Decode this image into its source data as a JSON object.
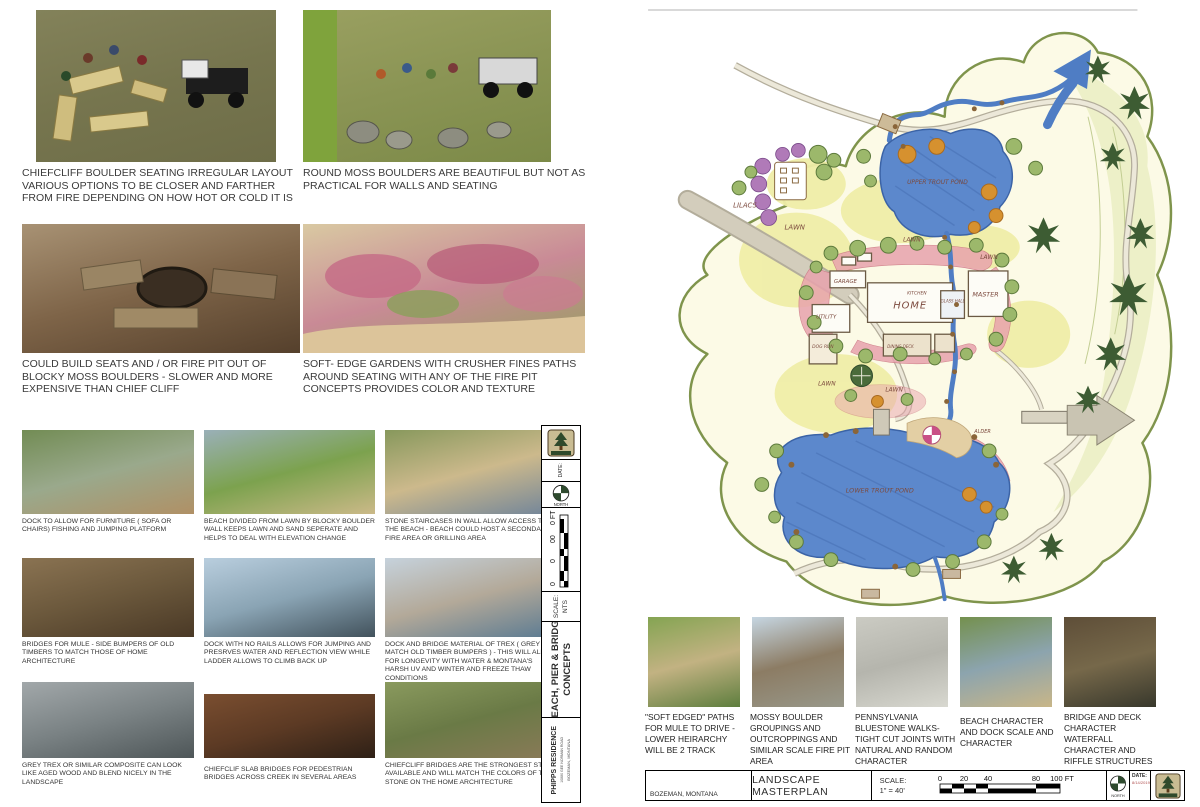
{
  "page_left": {
    "concepts": [
      {
        "id": "chiefcliff-seating-sketch",
        "caption": "CHIEFCLIFF BOULDER SEATING IRREGULAR LAYOUT VARIOUS OPTIONS TO BE CLOSER AND FARTHER FROM FIRE DEPENDING ON HOW HOT OR COLD IT IS",
        "colors": [
          "#83825a",
          "#76754e",
          "#6e6d48"
        ]
      },
      {
        "id": "round-moss-boulders-sketch",
        "caption": "ROUND MOSS BOULDERS ARE BEAUTIFUL BUT NOT AS PRACTICAL FOR WALLS AND SEATING",
        "colors": [
          "#9aa061",
          "#8a9454",
          "#7c8a48"
        ]
      },
      {
        "id": "blocky-moss-fire-pit-photo",
        "caption": "COULD BUILD SEATS AND  / OR FIRE PIT OUT OF BLOCKY MOSS BOULDERS - SLOWER AND MORE EXPENSIVE THAN CHIEF CLIFF",
        "colors": [
          "#a89274",
          "#7e6448",
          "#55402c"
        ]
      },
      {
        "id": "soft-edge-gardens-photo",
        "caption": "SOFT- EDGE GARDENS WITH CRUSHER FINES PATHS AROUND SEATING WITH ANY OF THE FIRE PIT CONCEPTS PROVIDES COLOR AND TEXTURE",
        "colors": [
          "#d9c9a2",
          "#c98a96",
          "#95a05e"
        ]
      }
    ],
    "grid": [
      {
        "id": "dock-furniture-photo",
        "caption": "DOCK TO ALLOW FOR FURNITURE   ( SOFA OR CHAIRS) FISHING AND JUMPING PLATFORM",
        "colors": [
          "#728c54",
          "#9aa98c",
          "#b09065"
        ]
      },
      {
        "id": "beach-lawn-wall-photo",
        "caption": "BEACH DIVIDED FROM LAWN BY BLOCKY BOULDER WALL KEEPS LAWN AND SAND SEPERATE AND HELPS TO DEAL WITH ELEVATION CHANGE",
        "colors": [
          "#9ab0b8",
          "#7ca24e",
          "#cbb988"
        ]
      },
      {
        "id": "stone-staircase-photo",
        "caption": "STONE STAIRCASES IN WALL ALLOW ACCESS TO THE BEACH - BEACH COULD HOST A SECONDARY FIRE AREA OR GRILLING AREA",
        "colors": [
          "#87985c",
          "#ccb98c",
          "#70849a"
        ]
      },
      {
        "id": "mule-bridge-photo",
        "caption": "BRIDGES FOR MULE - SIDE BUMPERS OF OLD TIMBERS TO MATCH THOSE OF HOME ARCHITECTURE",
        "colors": [
          "#8a7352",
          "#6b583c",
          "#4a3926"
        ]
      },
      {
        "id": "dock-no-rails-photo",
        "caption": "DOCK WITH NO RAILS ALLOWS FOR JUMPING AND PRESRVES WATER AND REFLECTION VIEW WHILE LADDER ALLOWS TO CLIMB BACK UP",
        "colors": [
          "#b9cede",
          "#8aa4b4",
          "#42525c"
        ]
      },
      {
        "id": "trex-dock-photo",
        "caption": "DOCK AND BRIDGE MATERIAL OF TREX  ( GREY TO MATCH OLD TIMBER BUMPERS )  - THIS WILL ALLOW FOR LONGEVITY WITH WATER & MONTANA'S HARSH UV AND WINTER AND FREEZE THAW CONDITIONS",
        "colors": [
          "#c6d2dc",
          "#b3a999",
          "#5a7a92"
        ]
      },
      {
        "id": "grey-trex-photo",
        "caption": "GREY TREX OR SIMILAR COMPOSITE CAN LOOK LIKE AGED WOOD AND BLEND NICELY IN THE LANDSCAPE",
        "colors": [
          "#a2a8aa",
          "#7a8284",
          "#4e5658"
        ]
      },
      {
        "id": "chiefclif-slab-bridge-photo",
        "caption": "CHIEFCLIF SLAB BRIDGES FOR PEDESTRIAN BRIDGES ACROSS CREEK IN SEVERAL AREAS",
        "colors": [
          "#7a4e30",
          "#5c3a24",
          "#2e2016"
        ]
      },
      {
        "id": "chiefcliff-bridge-stone-photo",
        "caption": "CHIEFCLIFF  BRIDGES ARE THE STRONGEST STONE AVAILABLE AND WILL MATCH THE COLORS OF THE STONE ON THE HOME ARCHITECTURE",
        "colors": [
          "#8a9a5e",
          "#6a7a46",
          "#8a7a58"
        ]
      }
    ],
    "titleblock": {
      "title_line1": "BEACH, PIER & BRIDGE",
      "title_line2": "CONCEPTS",
      "project": "PHIPPS RESIDENCE",
      "address": "10880 GEE NORMAN ROAD",
      "city": "BOZEMAN, MONTANA",
      "scale_label": "SCALE:",
      "scale_value": "NTS",
      "scale_ticks": [
        "0",
        "0",
        "00",
        "0 FT"
      ],
      "north_label": "NORTH",
      "date_label": "DATE:"
    }
  },
  "page_right": {
    "plan_labels": {
      "lilacs": "LILACS",
      "lawn": "LAWN",
      "garage": "GARAGE",
      "home": "HOME",
      "kitchen": "KITCHEN",
      "glass_hall": "GLASS HALL",
      "master": "MASTER",
      "utility": "UTILITY",
      "dog_run": "DOG RUN",
      "dining_deck": "DINING DECK",
      "upper_pond": "UPPER TROUT POND",
      "lower_pond": "LOWER TROUT POND",
      "alder": "ALDER"
    },
    "strip": [
      {
        "id": "soft-edged-path-photo",
        "caption": "\"SOFT EDGED\" PATHS FOR MULE TO DRIVE - LOWER HEIRARCHY WILL BE 2 TRACK",
        "colors": [
          "#84a452",
          "#c2b282",
          "#5e7e3e"
        ]
      },
      {
        "id": "mossy-boulder-firepit-photo",
        "caption": "MOSSY BOULDER GROUPINGS AND OUTCROPPINGS AND SIMILAR SCALE FIRE PIT AREA",
        "colors": [
          "#c6d6e2",
          "#8c7c64",
          "#98988a"
        ]
      },
      {
        "id": "bluestone-walk-photo",
        "caption": "PENNSYLVANIA BLUESTONE WALKS- TIGHT CUT JOINTS WITH NATURAL  AND RANDOM CHARACTER",
        "colors": [
          "#cbcbc3",
          "#b5b5ad",
          "#d8d8d0"
        ]
      },
      {
        "id": "beach-dock-character-photo",
        "caption": "BEACH CHARACTER AND DOCK SCALE AND CHARACTER",
        "colors": [
          "#74904e",
          "#8ca4ae",
          "#c8b688"
        ]
      },
      {
        "id": "bridge-deck-waterfall-photo",
        "caption": "BRIDGE AND DECK CHARACTER WATERFALL CHARACTER AND RIFFLE STRUCTURES",
        "colors": [
          "#5e4e38",
          "#76684a",
          "#38382c"
        ]
      }
    ],
    "titleblock": {
      "city": "BOZEMAN, MONTANA",
      "sheet_title": "LANDSCAPE  MASTERPLAN",
      "scale_label": "SCALE:",
      "scale_value": "1\" = 40'",
      "scale_ticks": [
        "0",
        "20",
        "40",
        "80",
        "100 FT"
      ],
      "north_label": "NORTH",
      "date_label": "DATE:",
      "date_value": "8/14/2019"
    }
  }
}
